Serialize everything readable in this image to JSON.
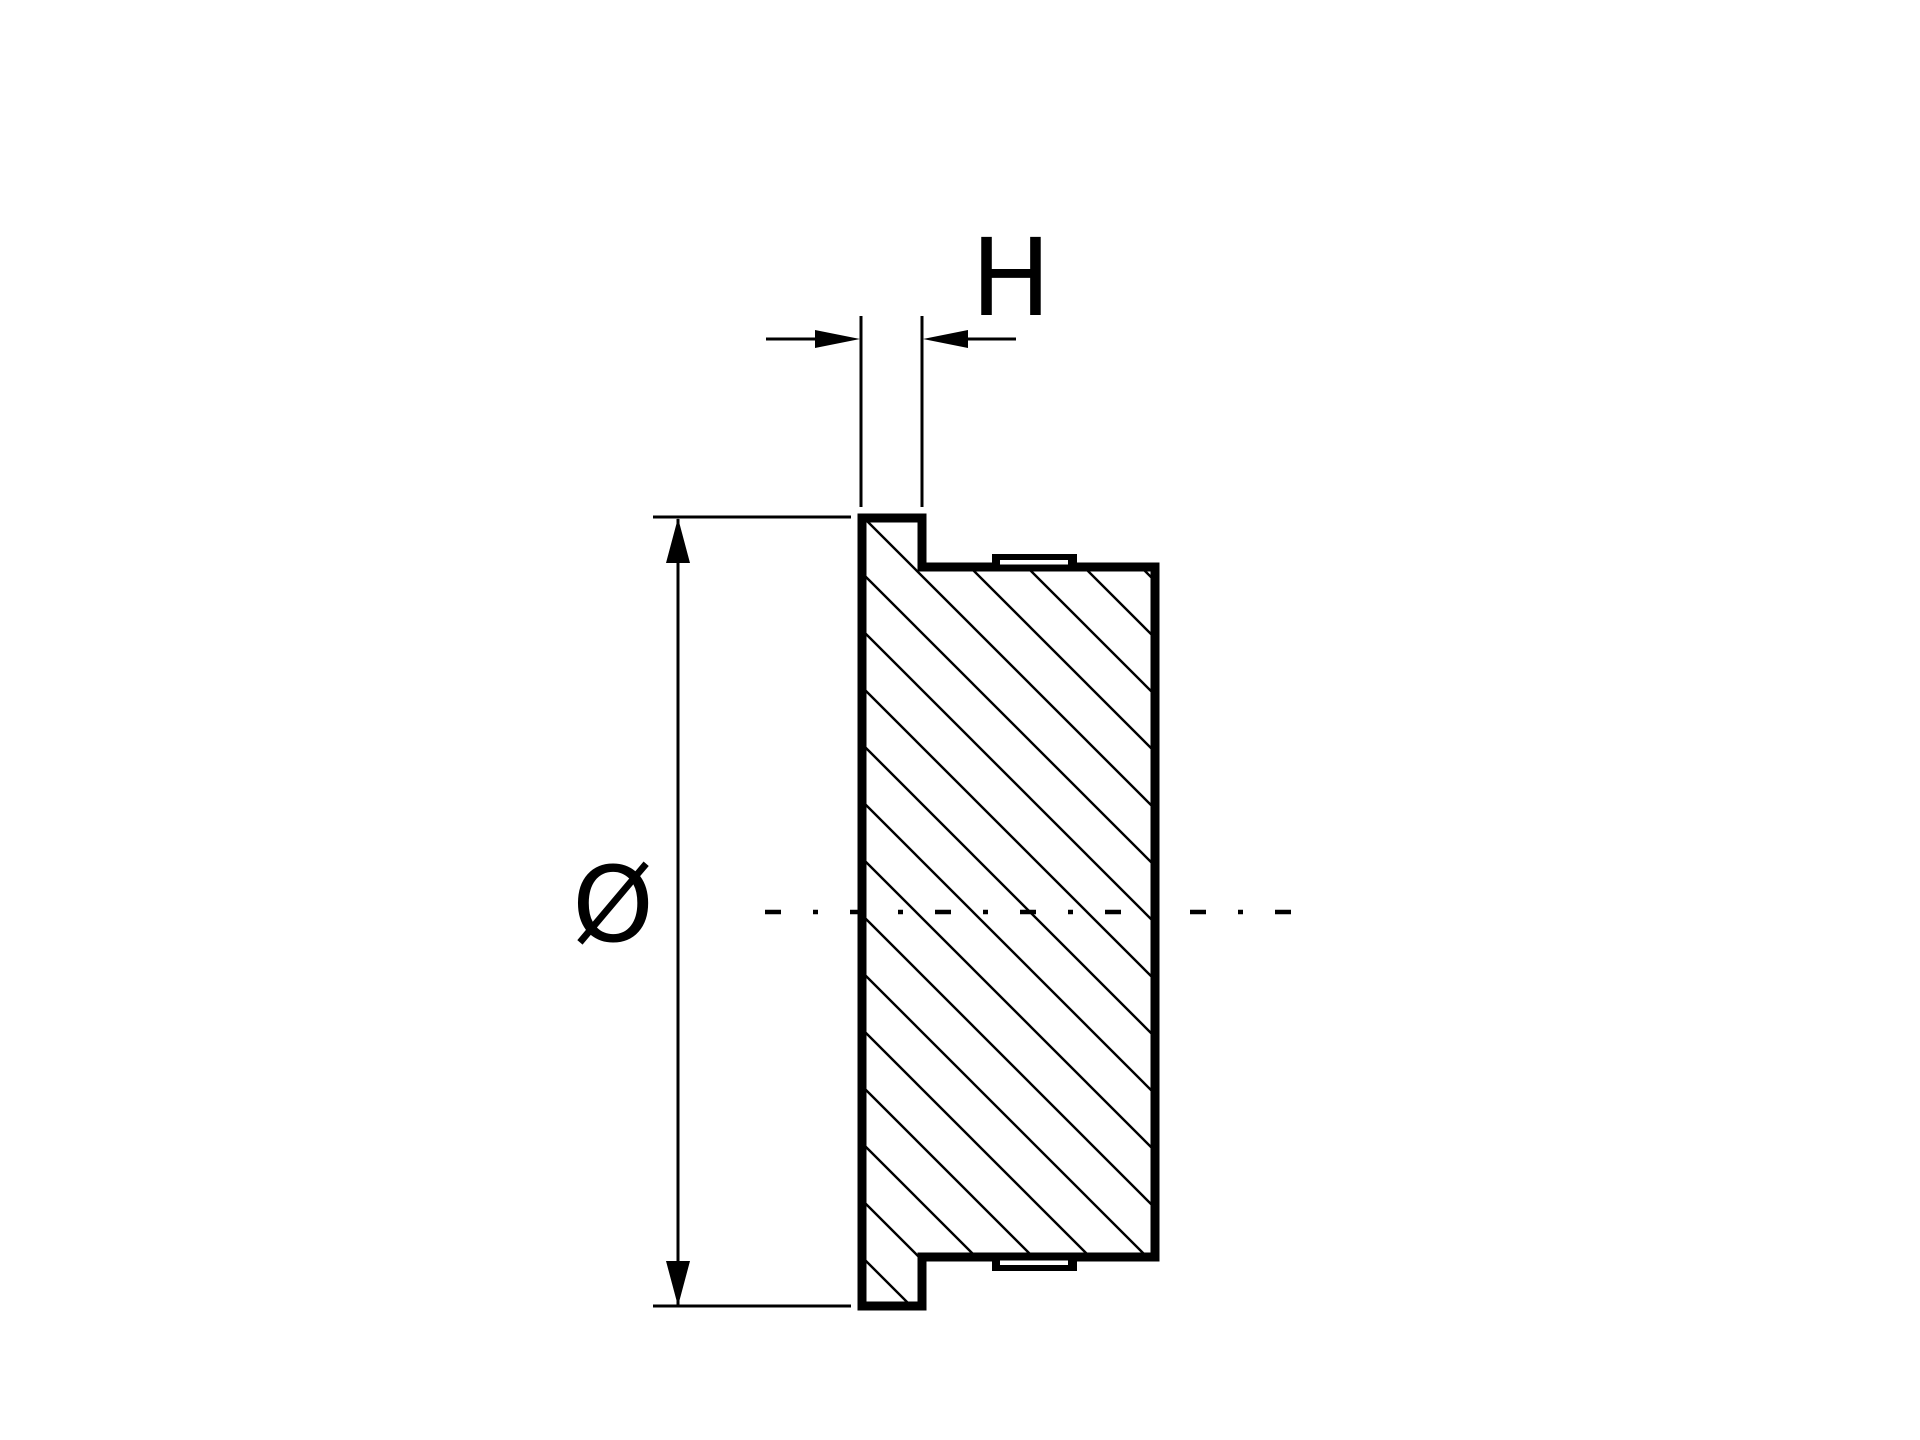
{
  "page": {
    "paper_color": "#ffffff",
    "ink_color": "#000000"
  },
  "drawing": {
    "view": "cross-section of flanged end cap",
    "labels": {
      "thickness": "H",
      "diameter": "Ø"
    }
  }
}
